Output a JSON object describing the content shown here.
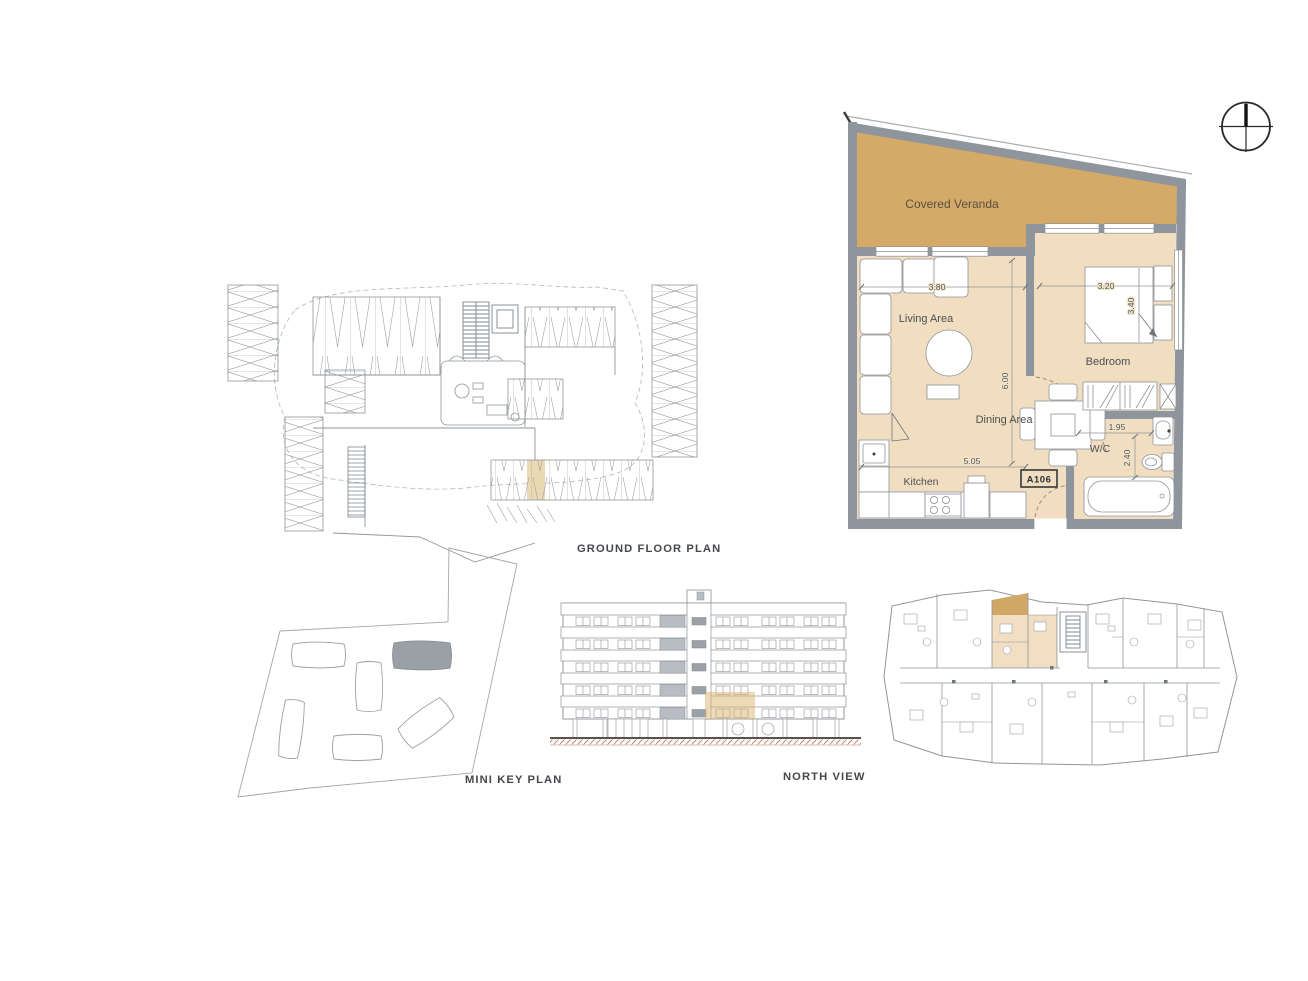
{
  "colors": {
    "veranda_fill": "#d5aa68",
    "interior_fill": "#f1dec1",
    "wall_gray": "#8e959c",
    "elevation_highlight": "#deb36f",
    "parking_highlight": "#ecd9b4",
    "key_plan_building_gray": "#99a0a6",
    "drawing_line_gray": "#9aa0a5",
    "ground_hatch_red": "#a85a3e",
    "caption_text": "#44474b"
  },
  "apartment_plan": {
    "unit_label": "A106",
    "room_labels": {
      "covered_veranda": "Covered Veranda",
      "living_area": "Living Area",
      "bedroom": "Bedroom",
      "dining_area": "Dining Area",
      "kitchen": "Kitchen",
      "wc": "W/C"
    },
    "dimensions": {
      "living_width": "3.80",
      "bedroom_width": "3.20",
      "bedroom_depth": "3.40",
      "living_depth": "6.00",
      "kitchen_dining_width": "5.05",
      "wc_width": "1.95",
      "wc_depth": "2.40"
    }
  },
  "captions": {
    "ground_floor_plan": "GROUND FLOOR PLAN",
    "mini_key_plan": "MINI KEY PLAN",
    "north_view": "NORTH VIEW"
  },
  "icons": {
    "north_indicator": "compass-north-icon"
  }
}
